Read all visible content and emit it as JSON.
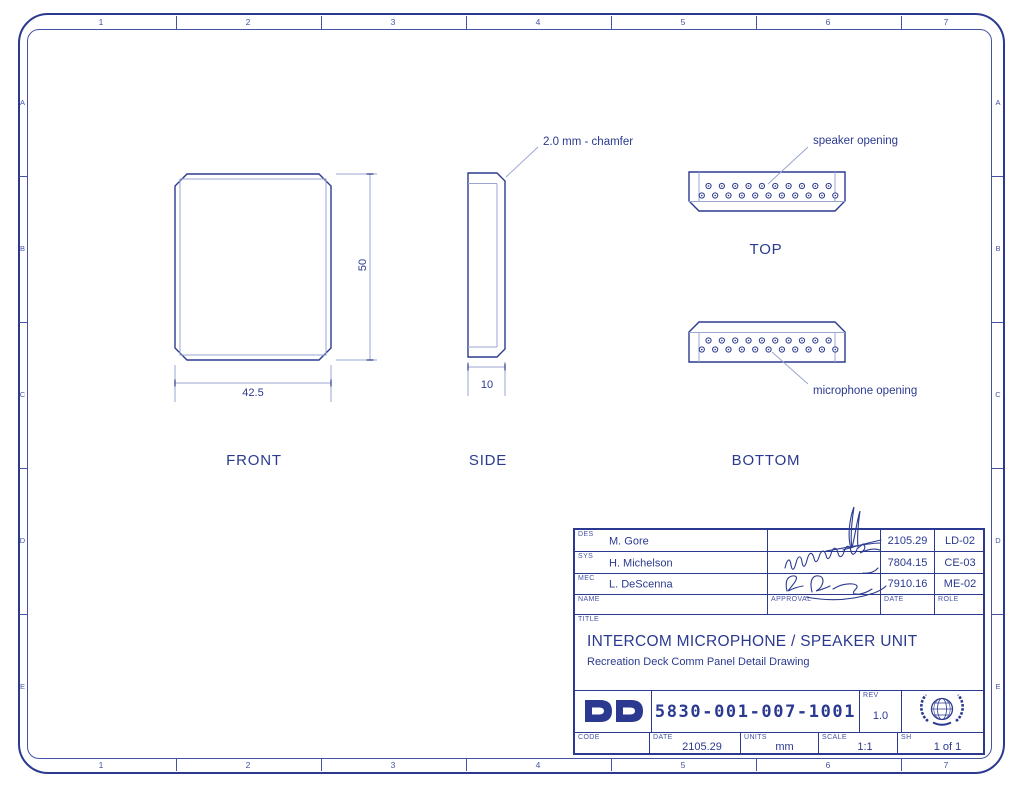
{
  "colors": {
    "ink": "#2b3a90",
    "light": "#9aa5d2",
    "background": "#ffffff"
  },
  "border": {
    "columns": [
      "1",
      "2",
      "3",
      "4",
      "5",
      "6",
      "7"
    ],
    "rows": [
      "A",
      "B",
      "C",
      "D",
      "E"
    ]
  },
  "views": {
    "front": {
      "label": "FRONT",
      "width_dim": "42.5",
      "height_dim": "50"
    },
    "side": {
      "label": "SIDE",
      "width_dim": "10",
      "chamfer_note": "2.0 mm - chamfer"
    },
    "top": {
      "label": "TOP",
      "note": "speaker opening"
    },
    "bottom": {
      "label": "BOTTOM",
      "note": "microphone opening"
    },
    "holes": {
      "upper_row_count": 10,
      "lower_row_count": 11
    }
  },
  "title_block": {
    "rows": [
      {
        "code": "DES",
        "name": "M. Gore",
        "date": "2105.29",
        "role": "LD-02"
      },
      {
        "code": "SYS",
        "name": "H. Michelson",
        "date": "7804.15",
        "role": "CE-03"
      },
      {
        "code": "MEC",
        "name": "L. DeScenna",
        "date": "7910.16",
        "role": "ME-02"
      }
    ],
    "footer": {
      "name": "NAME",
      "approval": "APPROVAL",
      "date": "DATE",
      "role": "ROLE"
    },
    "title_label": "TITLE",
    "title": "INTERCOM MICROPHONE / SPEAKER UNIT",
    "subtitle": "Recreation Deck Comm Panel Detail Drawing",
    "logo": "DD",
    "drawing_number": "5830-001-007-1001",
    "rev_label": "REV",
    "rev": "1.0",
    "code_label": "CODE",
    "date_label": "DATE",
    "date": "2105.29",
    "units_label": "UNITS",
    "units": "mm",
    "scale_label": "SCALE",
    "scale": "1:1",
    "sheet_label": "SH",
    "sheet": "1 of 1"
  }
}
